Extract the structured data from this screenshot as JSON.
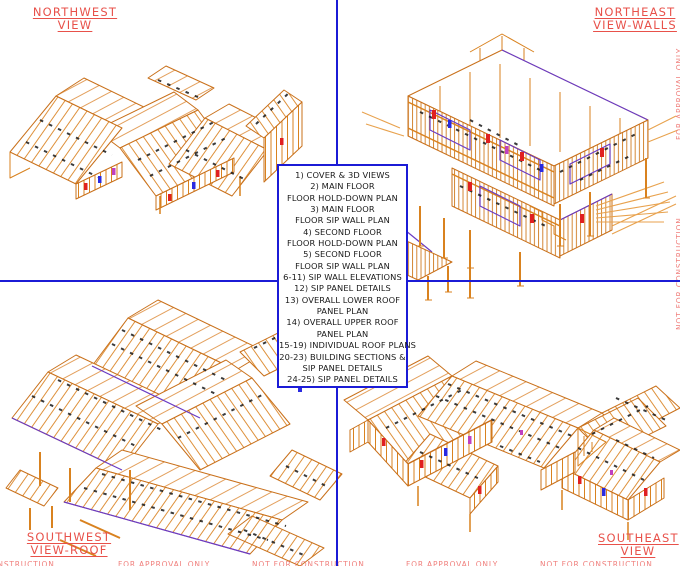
{
  "sheet": {
    "views": {
      "northwest": {
        "label": [
          "NORTHWEST",
          "VIEW"
        ]
      },
      "northeast": {
        "label": [
          "NORTHEAST",
          "VIEW-WALLS"
        ]
      },
      "southwest": {
        "label": [
          "SOUTHWEST",
          "VIEW-ROOF"
        ]
      },
      "southeast": {
        "label": [
          "SOUTHEAST",
          "VIEW"
        ]
      }
    },
    "index": {
      "lines": [
        "1) COVER & 3D VIEWS",
        "2) MAIN FLOOR",
        "FLOOR HOLD-DOWN PLAN",
        "3) MAIN FLOOR",
        "FLOOR SIP WALL PLAN",
        "4) SECOND FLOOR",
        "FLOOR HOLD-DOWN PLAN",
        "5) SECOND FLOOR",
        "FLOOR SIP WALL PLAN",
        "6-11) SIP WALL ELEVATIONS",
        "12) SIP PANEL DETAILS",
        "13) OVERALL LOWER ROOF",
        "PANEL PLAN",
        "14) OVERALL UPPER ROOF",
        "PANEL PLAN",
        "15-19) INDIVIDUAL ROOF PLANS",
        "20-23) BUILDING SECTIONS &",
        "SIP PANEL DETAILS",
        "24-25) SIP PANEL DETAILS"
      ]
    },
    "watermarks": {
      "bottom": [
        "NOT FOR CONSTRUCTION",
        "FOR APPROVAL ONLY",
        "NOT FOR CONSTRUCTION",
        "FOR APPROVAL ONLY",
        "NOT FOR CONSTRUCTION"
      ],
      "right": [
        "FOR APPROVAL ONLY",
        "NOT FOR CONSTRUCTION"
      ]
    },
    "colors": {
      "divider_blue": "#1b1bd6",
      "label_red": "#e8514a",
      "watermark_red": "#f0807d",
      "drawing_orange": "#d9821f",
      "detail_black": "#191919",
      "accent_purple": "#5538cc",
      "accent_red": "#e02020",
      "accent_magenta": "#c040c0"
    }
  }
}
